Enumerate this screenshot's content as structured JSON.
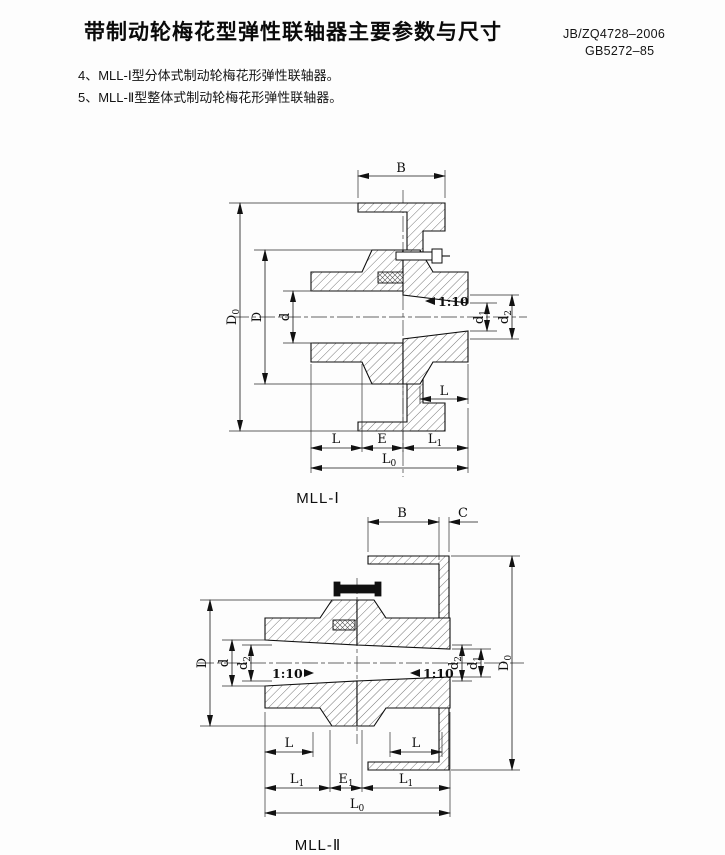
{
  "page": {
    "title": "带制动轮梅花型弹性联轴器主要参数与尺寸",
    "standard_line1": "JB/ZQ4728–2006",
    "standard_line2": "GB5272–85",
    "note4": "4、MLL-Ⅰ型分体式制动轮梅花形弹性联轴器。",
    "note5": "5、MLL-Ⅱ型整体式制动轮梅花形弹性联轴器。"
  },
  "d1": {
    "caption": "MLL-Ⅰ",
    "B": "B",
    "D": "D",
    "d": "d",
    "E": "E",
    "L": "L",
    "L_hub": "L",
    "taper": "1:10",
    "D0": {
      "main": "D",
      "sub": "0"
    },
    "d1": {
      "main": "d",
      "sub": "1"
    },
    "d2": {
      "main": "d",
      "sub": "2"
    },
    "L1": {
      "main": "L",
      "sub": "1"
    },
    "L0": {
      "main": "L",
      "sub": "0"
    }
  },
  "d2": {
    "caption": "MLL-Ⅱ",
    "B": "B",
    "C": "C",
    "D": "D",
    "d": "d",
    "L_left": "L",
    "L_right": "L",
    "taper_left": "1:10",
    "taper_right": "1:10",
    "D0": {
      "main": "D",
      "sub": "0"
    },
    "d1": {
      "main": "d",
      "sub": "1"
    },
    "d2_left": {
      "main": "d",
      "sub": "2"
    },
    "d2_right": {
      "main": "d",
      "sub": "2"
    },
    "E1": {
      "main": "E",
      "sub": "1"
    },
    "L1_left": {
      "main": "L",
      "sub": "1"
    },
    "L1_right": {
      "main": "L",
      "sub": "1"
    },
    "L0": {
      "main": "L",
      "sub": "0"
    }
  }
}
